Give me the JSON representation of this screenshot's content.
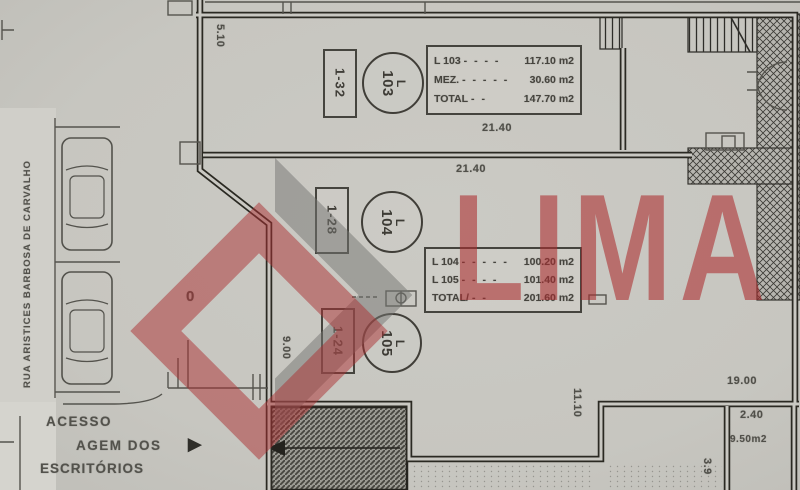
{
  "street": {
    "name": "RUA ARISTICES BARBOSA DE CARVALHO"
  },
  "watermark": {
    "text": "LIMA"
  },
  "access": {
    "line1": "ACESSO",
    "line2": "AGEM DOS",
    "line3": "ESCRITÓRIOS",
    "arrow": "►"
  },
  "units": {
    "u103": {
      "stall": "1-32",
      "letter": "L",
      "number": "103"
    },
    "u104": {
      "stall": "1-28",
      "letter": "L",
      "number": "104"
    },
    "u105": {
      "stall": "1-24",
      "letter": "L",
      "number": "105"
    }
  },
  "area_table_103": {
    "rows": [
      {
        "label": "L 103",
        "dashes": "- - - -",
        "value": "117.10 m2"
      },
      {
        "label": "MEZ.",
        "dashes": "- - - - -",
        "value": "30.60 m2"
      },
      {
        "label": "TOTAL",
        "dashes": "- -",
        "value": "147.70 m2"
      }
    ]
  },
  "area_table_104_105": {
    "rows": [
      {
        "label": "L 104",
        "dashes": "- - - - -",
        "value": "100.20 m2"
      },
      {
        "label": "L 105",
        "dashes": "- - - -",
        "value": "101.40 m2"
      },
      {
        "label": "TOTAL/",
        "dashes": "- -",
        "value": "201.60 m2"
      }
    ]
  },
  "dimensions": {
    "top_width": "5.10",
    "width_103": "21.40",
    "width_104": "21.40",
    "left_depth": "9.00",
    "right_depth": "11.10",
    "bottom_width": "19.00",
    "patio_width": "2.40",
    "patio_area": "9.50m2",
    "patio_depth": "3.9",
    "zero_mark": "0"
  }
}
